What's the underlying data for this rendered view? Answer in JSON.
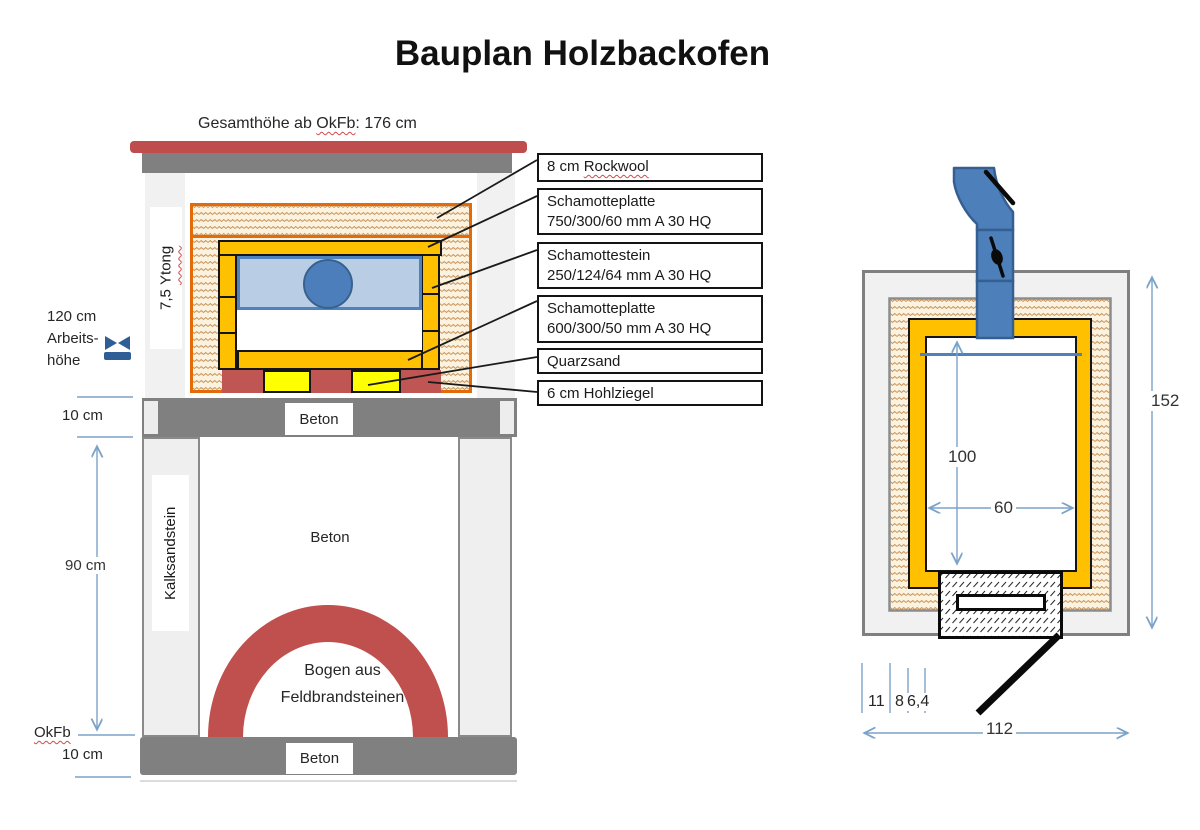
{
  "title": "Bauplan Holzbackofen",
  "section_view": {
    "height_note": {
      "prefix": "Gesamthöhe ab ",
      "term": "OkFb",
      "suffix": ": 176 cm"
    },
    "work_height": {
      "line1": "120 cm",
      "line2": "Arbeits-",
      "line3": "höhe"
    },
    "ytong": {
      "prefix": "7,5 ",
      "term": "Ytong"
    },
    "dim_slab_top": "10 cm",
    "dim_wall": "90 cm",
    "okfb": "OkFb",
    "dim_slab_bottom": "10 cm",
    "kalksandstein": "Kalksandstein",
    "beton_upper": "Beton",
    "beton_middle": "Beton",
    "beton_lower": "Beton",
    "arch_line1": "Bogen aus",
    "arch_line2": "Feldbrandsteinen",
    "callouts": [
      {
        "prefix": "8 cm ",
        "term": "Rockwool"
      },
      {
        "line1": "Schamotteplatte",
        "line2": "750/300/60  mm A 30 HQ"
      },
      {
        "line1": "Schamottestein",
        "line2": "250/124/64  mm A 30 HQ"
      },
      {
        "line1": "Schamotteplatte",
        "line2": "600/300/50  mm A 30 HQ"
      },
      {
        "line1": "Quarzsand"
      },
      {
        "line1": "6 cm Hohlziegel"
      }
    ]
  },
  "plan_view": {
    "dim_inner_height": "100",
    "dim_inner_width": "60",
    "dim_outer_height": "152",
    "dim_outer_width": "112",
    "layer_dims": [
      "11",
      "8",
      "6,4"
    ]
  },
  "colors": {
    "gold": "#ffc000",
    "brick_red": "#c0504d",
    "pipe_blue": "#4f81bd",
    "chamber_blue": "#b9cde4",
    "quartz_yellow": "#ffff00",
    "concrete_gray": "#808080",
    "insulation_border": "#e36c0a",
    "dimension_blue": "#7ba3c9"
  }
}
